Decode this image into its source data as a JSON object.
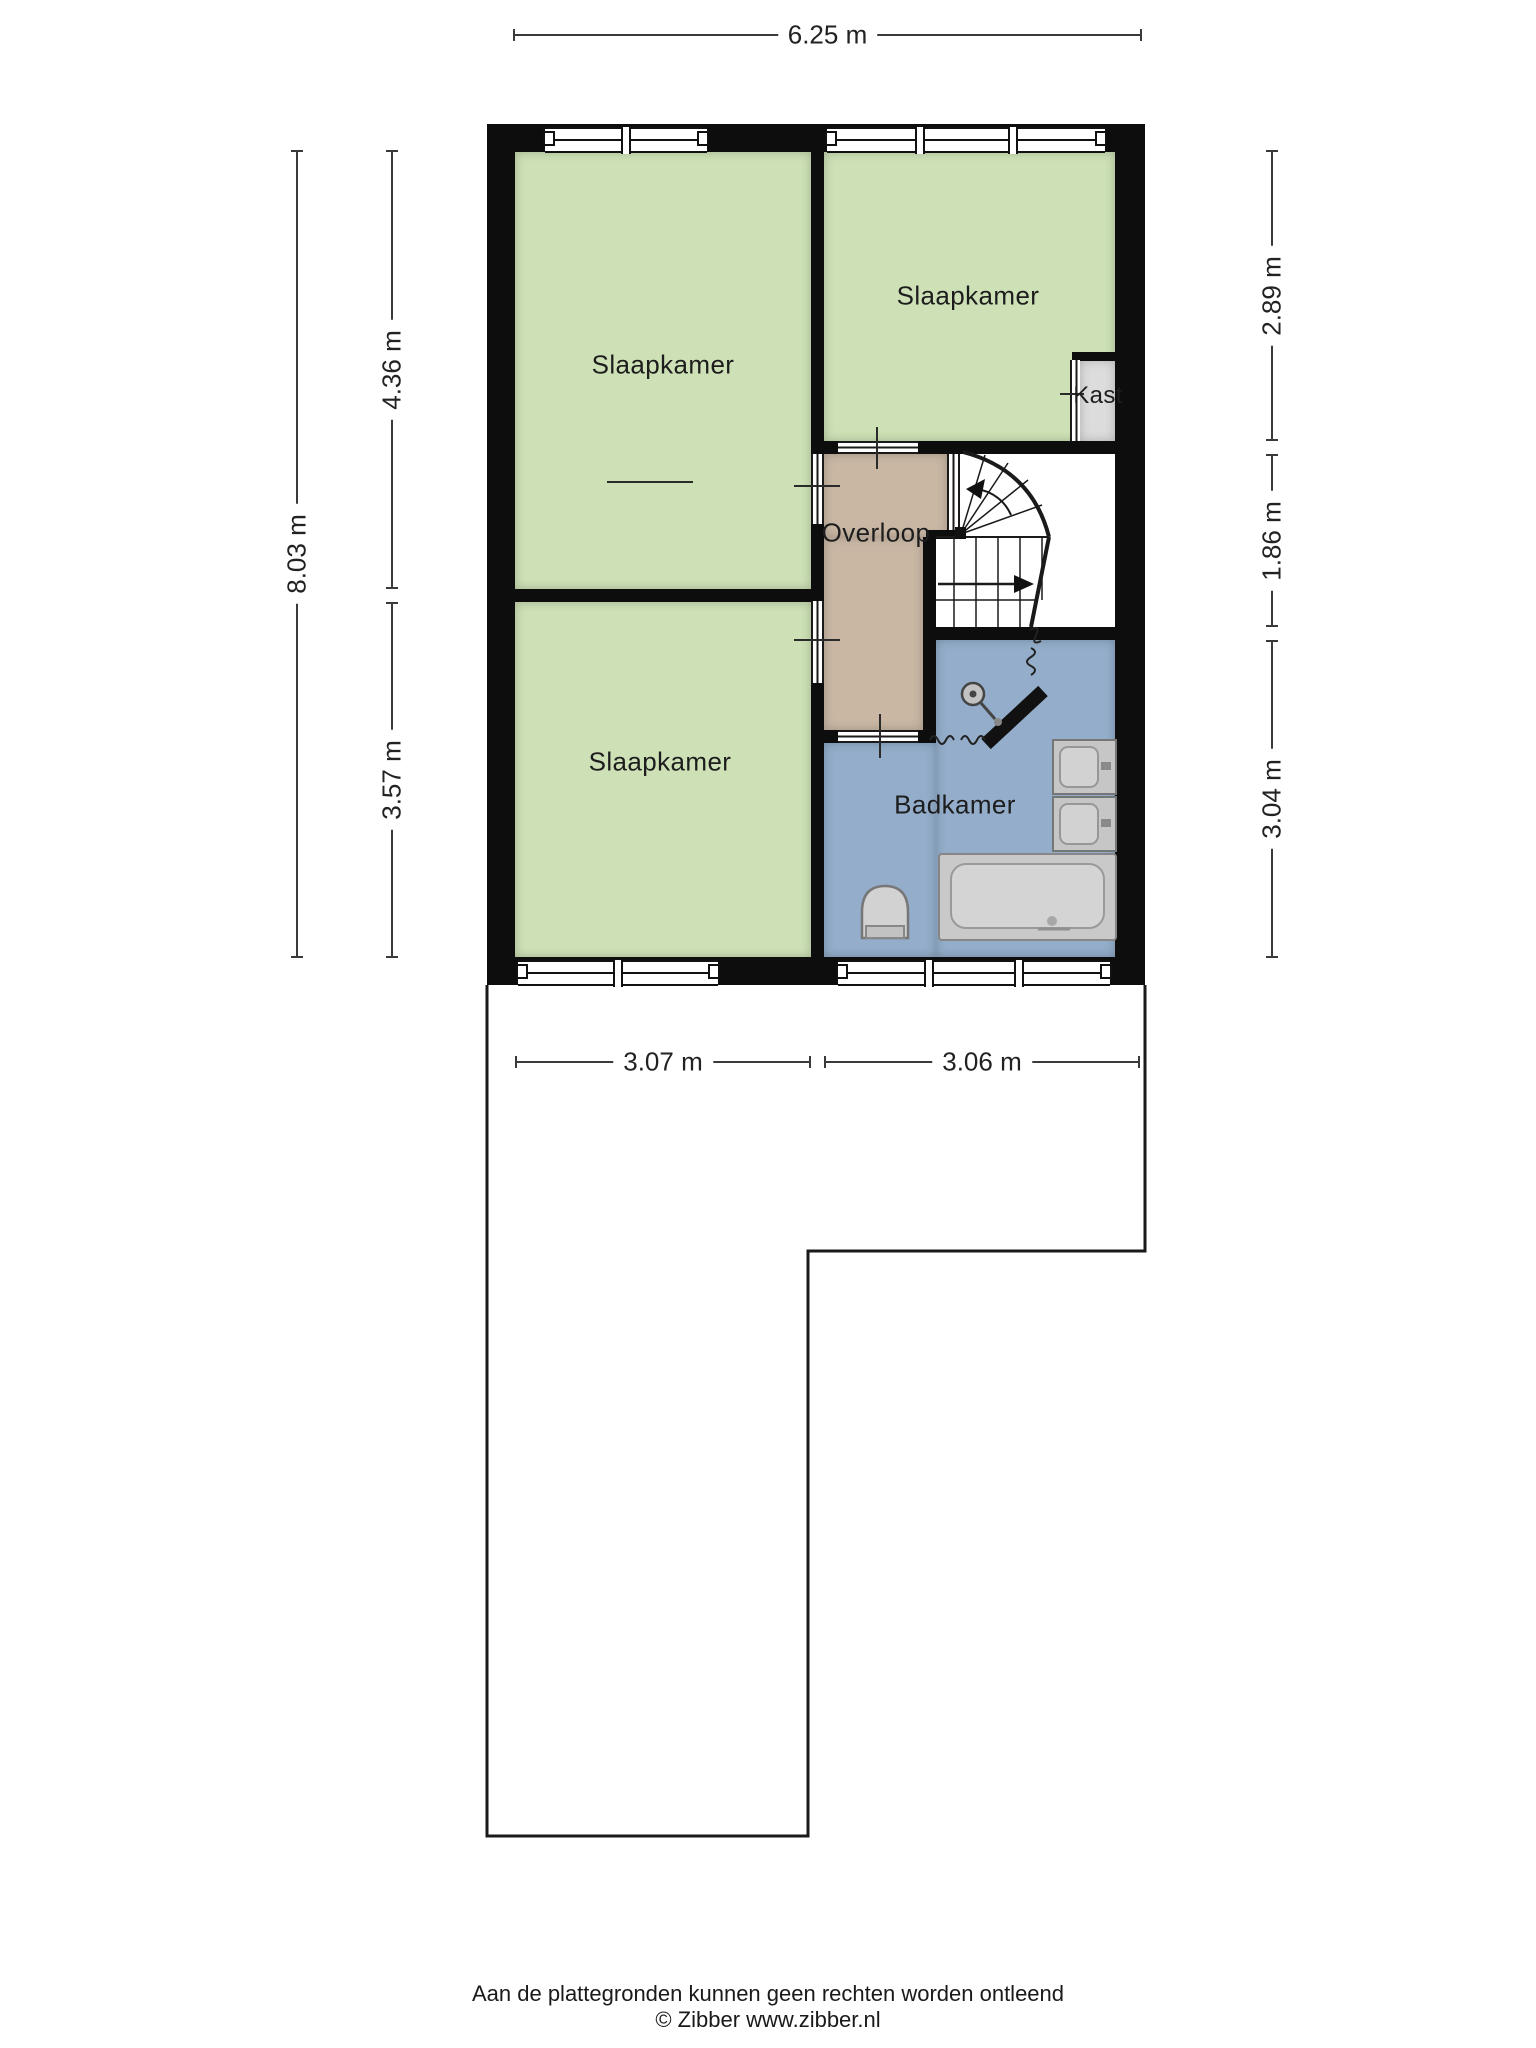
{
  "plan": {
    "rooms": {
      "slaapkamer_tl": {
        "label": "Slaapkamer"
      },
      "slaapkamer_tr": {
        "label": "Slaapkamer"
      },
      "slaapkamer_bl": {
        "label": "Slaapkamer"
      },
      "overloop": {
        "label": "Overloop"
      },
      "badkamer": {
        "label": "Badkamer"
      },
      "kast": {
        "label": "Kast"
      }
    },
    "dims": {
      "top": "6.25 m",
      "left_total": "8.03 m",
      "left_upper": "4.36 m",
      "left_lower": "3.57 m",
      "right_upper": "2.89 m",
      "right_middle": "1.86 m",
      "right_lower": "3.04 m",
      "bottom_left": "3.07 m",
      "bottom_right": "3.06 m"
    },
    "colors": {
      "bedroom": "#cde0b6",
      "landing": "#c9b7a4",
      "bathroom": "#93adca",
      "closet": "#dcdcdc",
      "wall": "#0d0d0d"
    }
  },
  "footer": {
    "disclaimer": "Aan de plattegronden kunnen geen rechten worden ontleend",
    "credit": "© Zibber www.zibber.nl"
  }
}
